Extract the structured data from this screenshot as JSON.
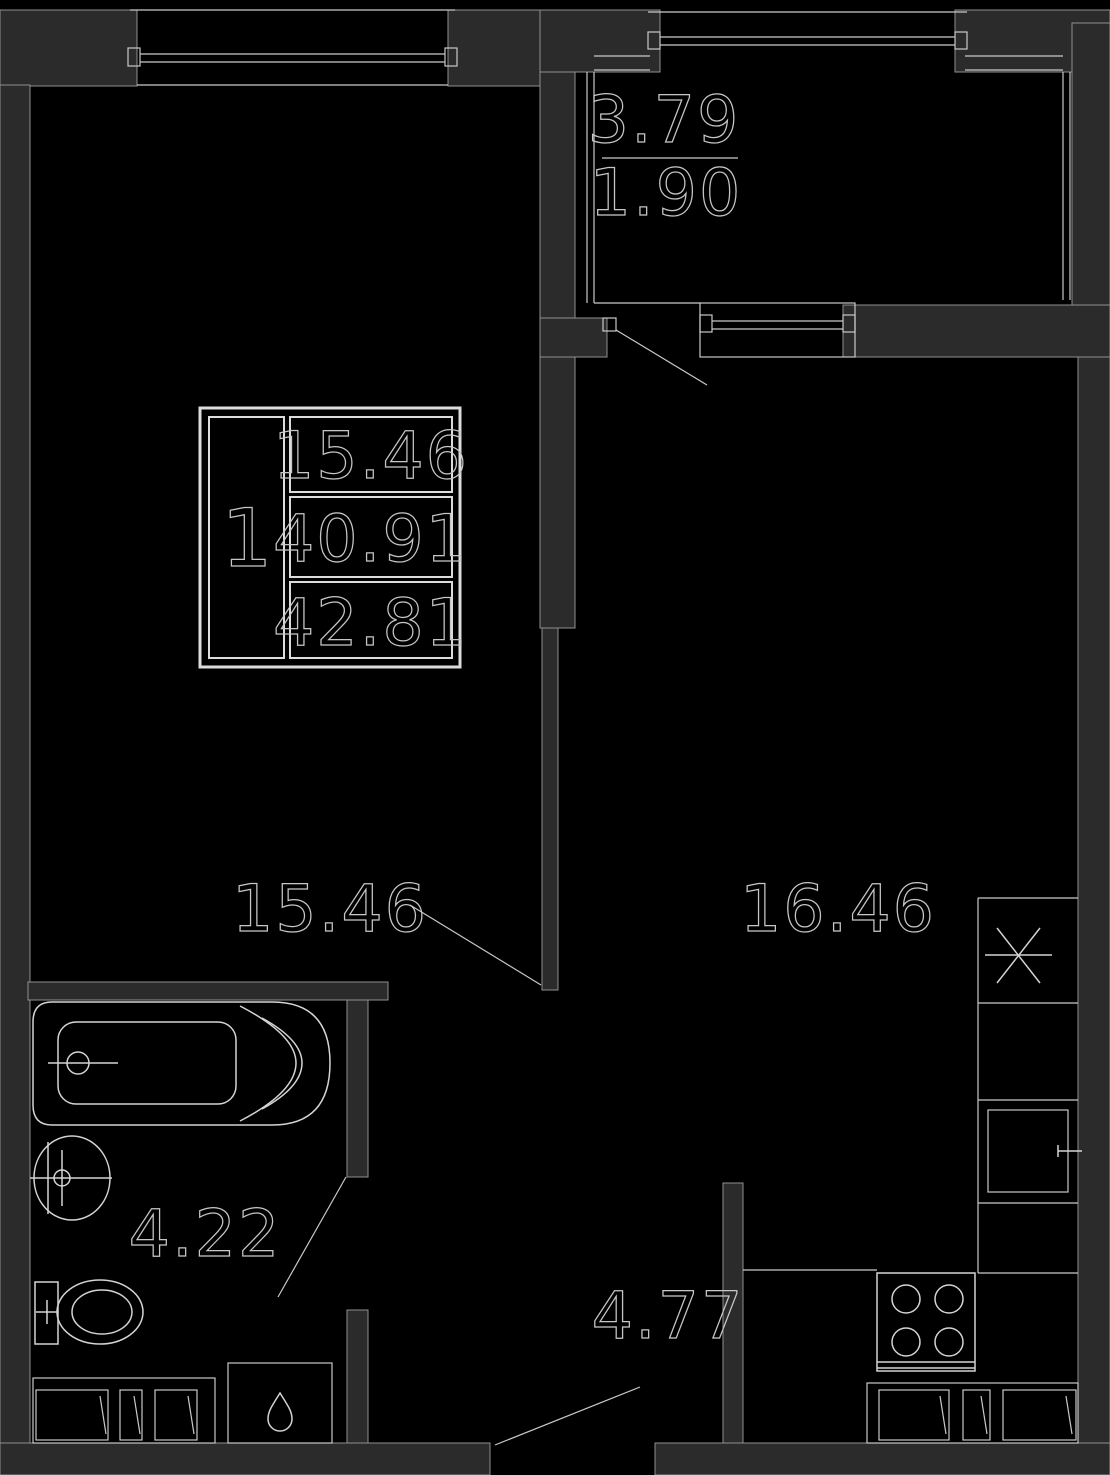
{
  "legend": {
    "rooms_count": "1",
    "living_area": "15.46",
    "total_area": "40.91",
    "total_area_with_balcony": "42.81"
  },
  "labels": {
    "living_room": "15.46",
    "kitchen": "16.46",
    "bathroom": "4.22",
    "hallway": "4.77",
    "balcony_area": "3.79",
    "balcony_reduced_area": "1.90"
  },
  "colors": {
    "background": "#000000",
    "wall_fill": "#2b2b2b",
    "line": "#c9c9c9",
    "text": "#c6c6c6"
  }
}
